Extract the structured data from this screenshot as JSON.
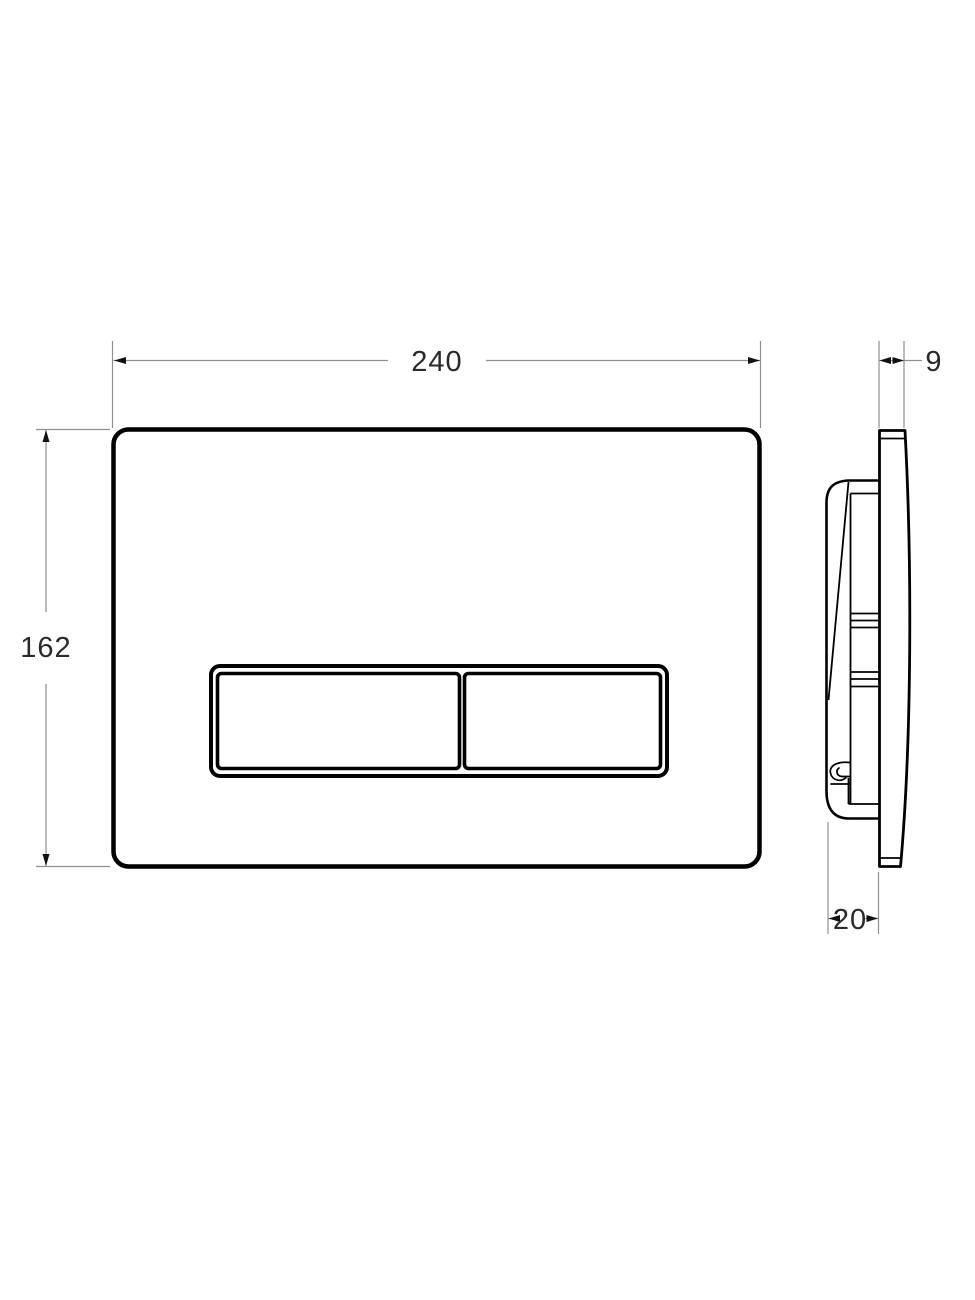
{
  "drawing": {
    "dimensions": {
      "width": {
        "label": "240"
      },
      "height": {
        "label": "162"
      },
      "plate_thickness": {
        "label": "9"
      },
      "frame_depth": {
        "label": "20"
      }
    },
    "colors": {
      "background": "#ffffff",
      "part_outline": "#000000",
      "dimension_line": "#8f8f8f",
      "arrowhead": "#111111",
      "dimension_text": "#2a2a2a"
    }
  }
}
